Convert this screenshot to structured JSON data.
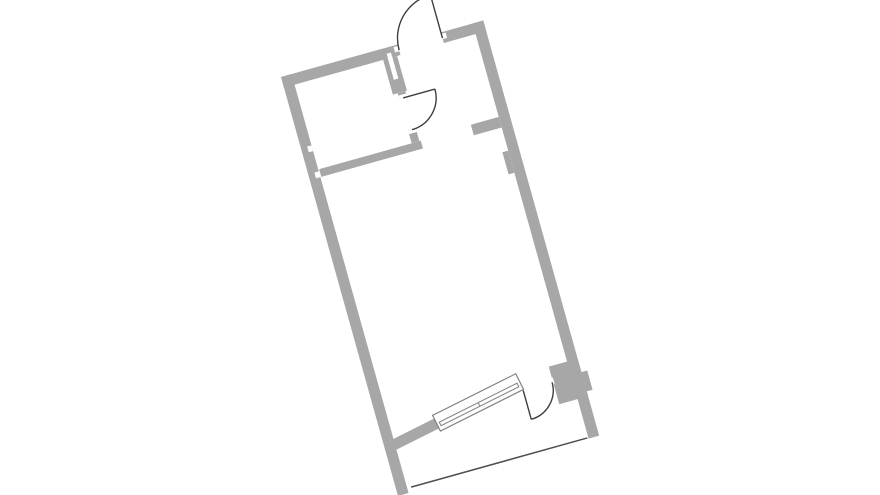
{
  "page": {
    "background": "#ffffff"
  },
  "floor_plan": {
    "origin_x": 281,
    "origin_y": 77,
    "rotation_deg": -15.6,
    "colors": {
      "wall": "#a7a7a7",
      "door_line": "#3e3e3e",
      "window_frame": "#828282",
      "balcony_line": "#4f4f4f",
      "opening": "#ffffff"
    },
    "walls": [
      {
        "name": "top-wall-left",
        "u": 0,
        "v": 0,
        "w": 121,
        "h": 11
      },
      {
        "name": "top-wall-right",
        "u": 166,
        "v": 0,
        "w": 44,
        "h": 11
      },
      {
        "name": "left-wall",
        "u": 0,
        "v": 0,
        "w": 11,
        "h": 435
      },
      {
        "name": "right-wall",
        "u": 199,
        "v": 0,
        "w": 11,
        "h": 431
      },
      {
        "name": "shaft-wall-left",
        "u": 103,
        "v": 11,
        "w": 5,
        "h": 22
      },
      {
        "name": "shaft-wall-right",
        "u": 112.5,
        "v": 11,
        "w": 5,
        "h": 36
      },
      {
        "name": "shaft-wall-cap",
        "u": 103,
        "v": 33,
        "w": 14.5,
        "h": 14
      },
      {
        "name": "bath-door-wall-upper",
        "u": 108,
        "v": 47,
        "w": 8,
        "h": 6
      },
      {
        "name": "bath-door-wall-lower",
        "u": 108,
        "v": 86,
        "w": 8,
        "h": 13
      },
      {
        "name": "bathroom-bottom-wall",
        "u": 12,
        "v": 99,
        "w": 105.5,
        "h": 8
      },
      {
        "name": "entry-stub-wall",
        "u": 170,
        "v": 97,
        "w": 29,
        "h": 11
      },
      {
        "name": "right-wall-pier",
        "u": 193,
        "v": 132,
        "w": 6,
        "h": 23
      },
      {
        "name": "balcony-door-pier",
        "u": 180,
        "v": 351,
        "w": 30,
        "h": 39
      },
      {
        "name": "balcony-outer-nub",
        "u": 210,
        "v": 365,
        "w": 6,
        "h": 20
      }
    ],
    "window_group": {
      "tilt_deg": -11,
      "pivot_u": 57,
      "pivot_v": 377,
      "wall": {
        "name": "window-wall-left",
        "u": 8,
        "v": 370,
        "w": 49,
        "h": 11
      },
      "frame": {
        "name": "window-frame",
        "u": 57,
        "v": 366.5,
        "w": 93,
        "h": 17.5
      },
      "glazing_bar": {
        "name": "window-glazing-bar",
        "u": 60,
        "v": 375.5,
        "w": 87,
        "h": 4
      },
      "divider_u": 103.5
    },
    "openings": [
      {
        "name": "shaft-slot",
        "u": 108,
        "v": 6,
        "w": 4.5,
        "h": 27
      },
      {
        "name": "entrance-left-jamb",
        "u": 116.5,
        "v": 1.5,
        "w": 5,
        "h": 5.5
      },
      {
        "name": "entrance-right-jamb",
        "u": 165.5,
        "v": 1.5,
        "w": 5,
        "h": 5.5
      },
      {
        "name": "bath-door-top-jamb",
        "u": 108,
        "v": 49.5,
        "w": 8,
        "h": 3.5
      },
      {
        "name": "bath-door-bottom-jamb",
        "u": 108,
        "v": 86,
        "w": 8,
        "h": 3.5
      },
      {
        "name": "balcony-door-jamb",
        "u": 176.5,
        "v": 362.5,
        "w": 4.5,
        "h": 7
      },
      {
        "name": "left-wall-notch-upper",
        "u": 6.5,
        "v": 74,
        "w": 4.5,
        "h": 6
      },
      {
        "name": "left-wall-notch-lower",
        "u": 6.5,
        "v": 101,
        "w": 4.5,
        "h": 6
      }
    ],
    "doors": [
      {
        "name": "entrance-door",
        "arc": "M 121 6 A 45 45 0 0 1 166 -39",
        "leaf": {
          "x1": 166,
          "y1": 6,
          "x2": 166,
          "y2": -39
        }
      },
      {
        "name": "bathroom-door",
        "arc": "M 145 53 A 33 33 0 0 1 112 86",
        "leaf": {
          "x1": 112,
          "y1": 53,
          "x2": 145,
          "y2": 53
        }
      },
      {
        "name": "balcony-door",
        "arc": "M 149 397 A 30 30 0 0 0 179 367",
        "leaf": {
          "x1": 149,
          "y1": 367,
          "x2": 149,
          "y2": 397
        }
      }
    ],
    "balcony_line": {
      "x1": 15,
      "y1": 430,
      "x2": 198,
      "y2": 430
    }
  }
}
